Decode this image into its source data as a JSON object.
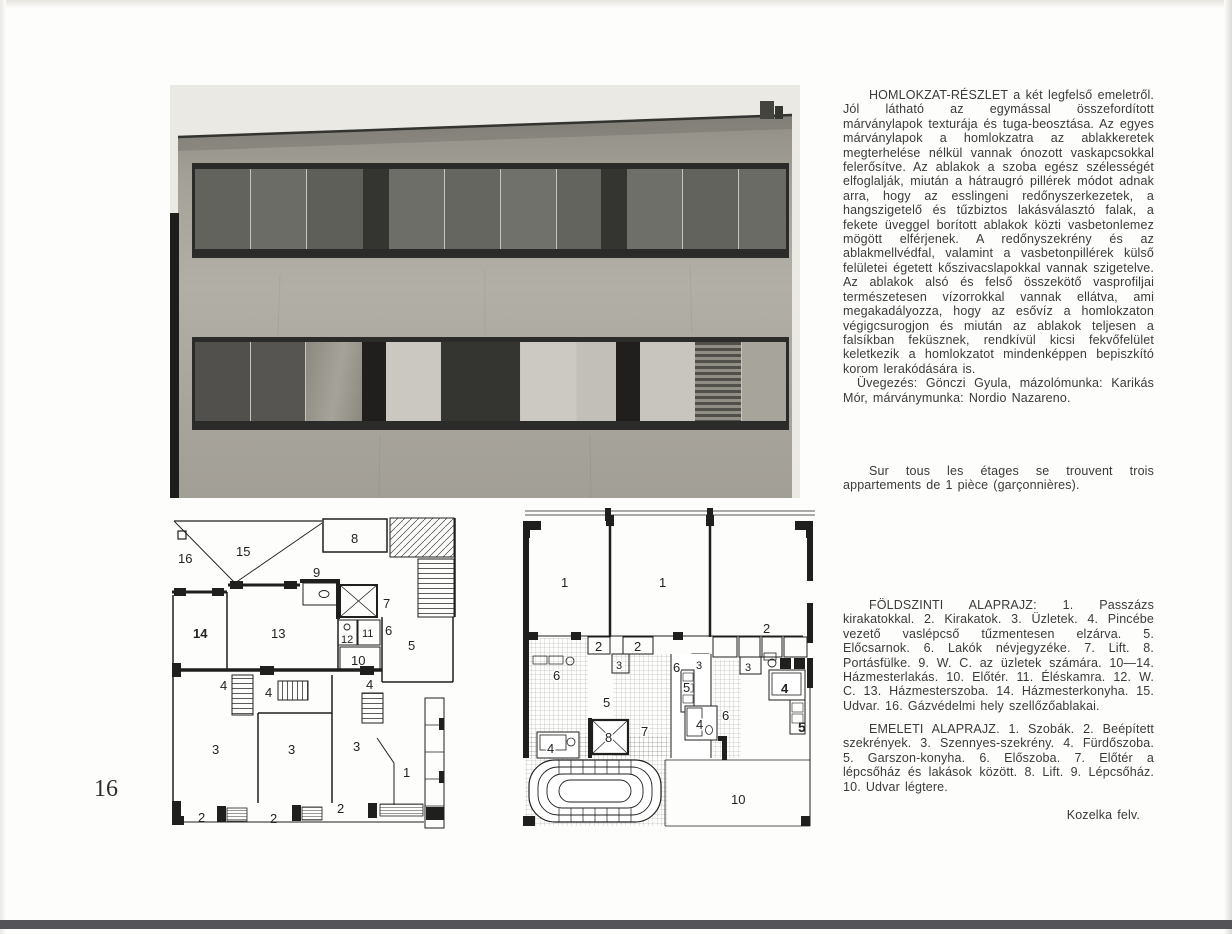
{
  "page": {
    "number": "16"
  },
  "colors": {
    "paper": "#fdfdfb",
    "ink": "#3a3a38",
    "photo_sky": "#ebe9e4",
    "photo_wall": "#aaa79e",
    "photo_frame": "#2b2b29",
    "scan_edge_bottom": "#545458"
  },
  "article": {
    "paragraph_main": "HOMLOKZAT-RÉSZLET a két legfelső emeletről. Jól látható az egymással összefordított márványlapok texturája és tuga-beosztása. Az egyes márványlapok a homlokzatra az ablakkeretek megterhelése nélkül vannak ónozott vaskapcsokkal felerősítve. Az ablakok a szoba egész szélességét elfoglalják, miután a hátraugró pillérek módot adnak arra, hogy az esslingeni redőnyszerkezetek, a hangszigetelő és tűzbiztos lakásválasztó falak, a fekete üveggel borított ablakok közti vasbetonlemez mögött elférjenek. A redőnyszekrény és az ablakmellvédfal, valamint a vasbetonpillérek külső felületei égetett kőszivacslapokkal vannak szigetelve. Az ablakok alsó és felső összekötő vasprofiljai természetesen vízorrokkal vannak ellátva, ami megakadályozza, hogy az esővíz a homlokzaton végigcsurogjon és miután az ablakok teljesen a falsíkban feküsznek, rendkívül kicsi fekvőfelület keletkezik a homlokzatot mindenképpen bepiszkító korom lerakódására is.",
    "paragraph_credits": "Üvegezés: Gönczi Gyula, mázolómunka: Karikás Mór, márványmunka: Nordio Nazareno.",
    "paragraph_french": "Sur tous les étages se trouvent trois appartements de 1 pièce (garçonnières).",
    "ground_plan_caption": "FÖLDSZINTI ALAPRAJZ: 1. Passzázs kirakatokkal. 2. Kirakatok. 3. Üzletek. 4. Pincébe vezető vaslépcső tűzmentesen elzárva. 5. Előcsarnok. 6. Lakók névjegyzéke. 7. Lift. 8. Portásfülke. 9. W. C. az üzletek számára. 10—14. Házmesterlakás. 10. Előtér. 11. Éléskamra. 12. W. C. 13. Házmesterszoba. 14. Házmesterkonyha. 15. Udvar. 16. Gázvédelmi hely szellőzőablakai.",
    "upper_plan_caption": "EMELETI ALAPRAJZ. 1. Szobák. 2. Beépített szekrények. 3. Szennyes-szekrény. 4. Fürdőszoba. 5. Garszon-konyha. 6. Előszoba. 7. Előtér a lépcsőház és lakások között. 8. Lift. 9. Lépcsőház. 10. Udvar légtere.",
    "photo_credit": "Kozelka felv."
  },
  "photo": {
    "upper_band": {
      "panes": [
        {
          "w": 57,
          "c": "#63635d"
        },
        {
          "w": 57,
          "c": "#6c6c66"
        },
        {
          "w": 57,
          "c": "#5f5f59"
        },
        {
          "w": 26,
          "c": "#343431",
          "type": "pier"
        },
        {
          "w": 57,
          "c": "#6e6e68"
        },
        {
          "w": 57,
          "c": "#666660"
        },
        {
          "w": 57,
          "c": "#71716b"
        },
        {
          "w": 45,
          "c": "#64645e"
        },
        {
          "w": 26,
          "c": "#343431",
          "type": "pier"
        },
        {
          "w": 57,
          "c": "#6f6f69"
        },
        {
          "w": 57,
          "c": "#63635d"
        },
        {
          "w": 48,
          "c": "#6b6b65"
        }
      ]
    },
    "lower_band": {
      "panes": [
        {
          "w": 57,
          "c": "#52504c"
        },
        {
          "w": 57,
          "c": "#575551"
        },
        {
          "w": 57,
          "c": "linear-gradient(100deg,#8b897f 0%,#a5a39a 55%,#8b897f 100%)"
        },
        {
          "w": 24,
          "c": "#201f1d",
          "type": "pier"
        },
        {
          "w": 57,
          "c": "#cac8c1"
        },
        {
          "w": 82,
          "c": "#343431"
        },
        {
          "w": 57,
          "c": "#ccc9c2"
        },
        {
          "w": 40,
          "c": "#c1bfb8"
        },
        {
          "w": 24,
          "c": "#201f1d",
          "type": "pier"
        },
        {
          "w": 57,
          "c": "#c7c5be"
        },
        {
          "w": 48,
          "type": "blinds"
        },
        {
          "w": 45,
          "c": "#a6a49b"
        }
      ]
    }
  },
  "plans": {
    "ground": {
      "labels": {
        "n16": "16",
        "n15": "15",
        "n8": "8",
        "n9": "9",
        "n7": "7",
        "n14": "14",
        "n13": "13",
        "n12": "12",
        "n11": "11",
        "n6": "6",
        "n10": "10",
        "n5": "5",
        "n4a": "4",
        "n4b": "4",
        "n4c": "4",
        "n3a": "3",
        "n3b": "3",
        "n3c": "3",
        "n1": "1",
        "n2a": "2",
        "n2b": "2",
        "n2c": "2"
      }
    },
    "upper": {
      "labels": {
        "r1a": "1",
        "r1b": "1",
        "r2a": "2",
        "r2b": "2",
        "r2c": "2",
        "r3a": "3",
        "r3b": "3",
        "r3c": "3",
        "r6a": "6",
        "r6b": "6",
        "r6c": "6",
        "r5a": "5",
        "r5b": "5",
        "r5out": "5",
        "r4a": "4",
        "r4b": "4",
        "r4c": "4",
        "r7": "7",
        "r8": "8",
        "r10": "10"
      }
    }
  }
}
